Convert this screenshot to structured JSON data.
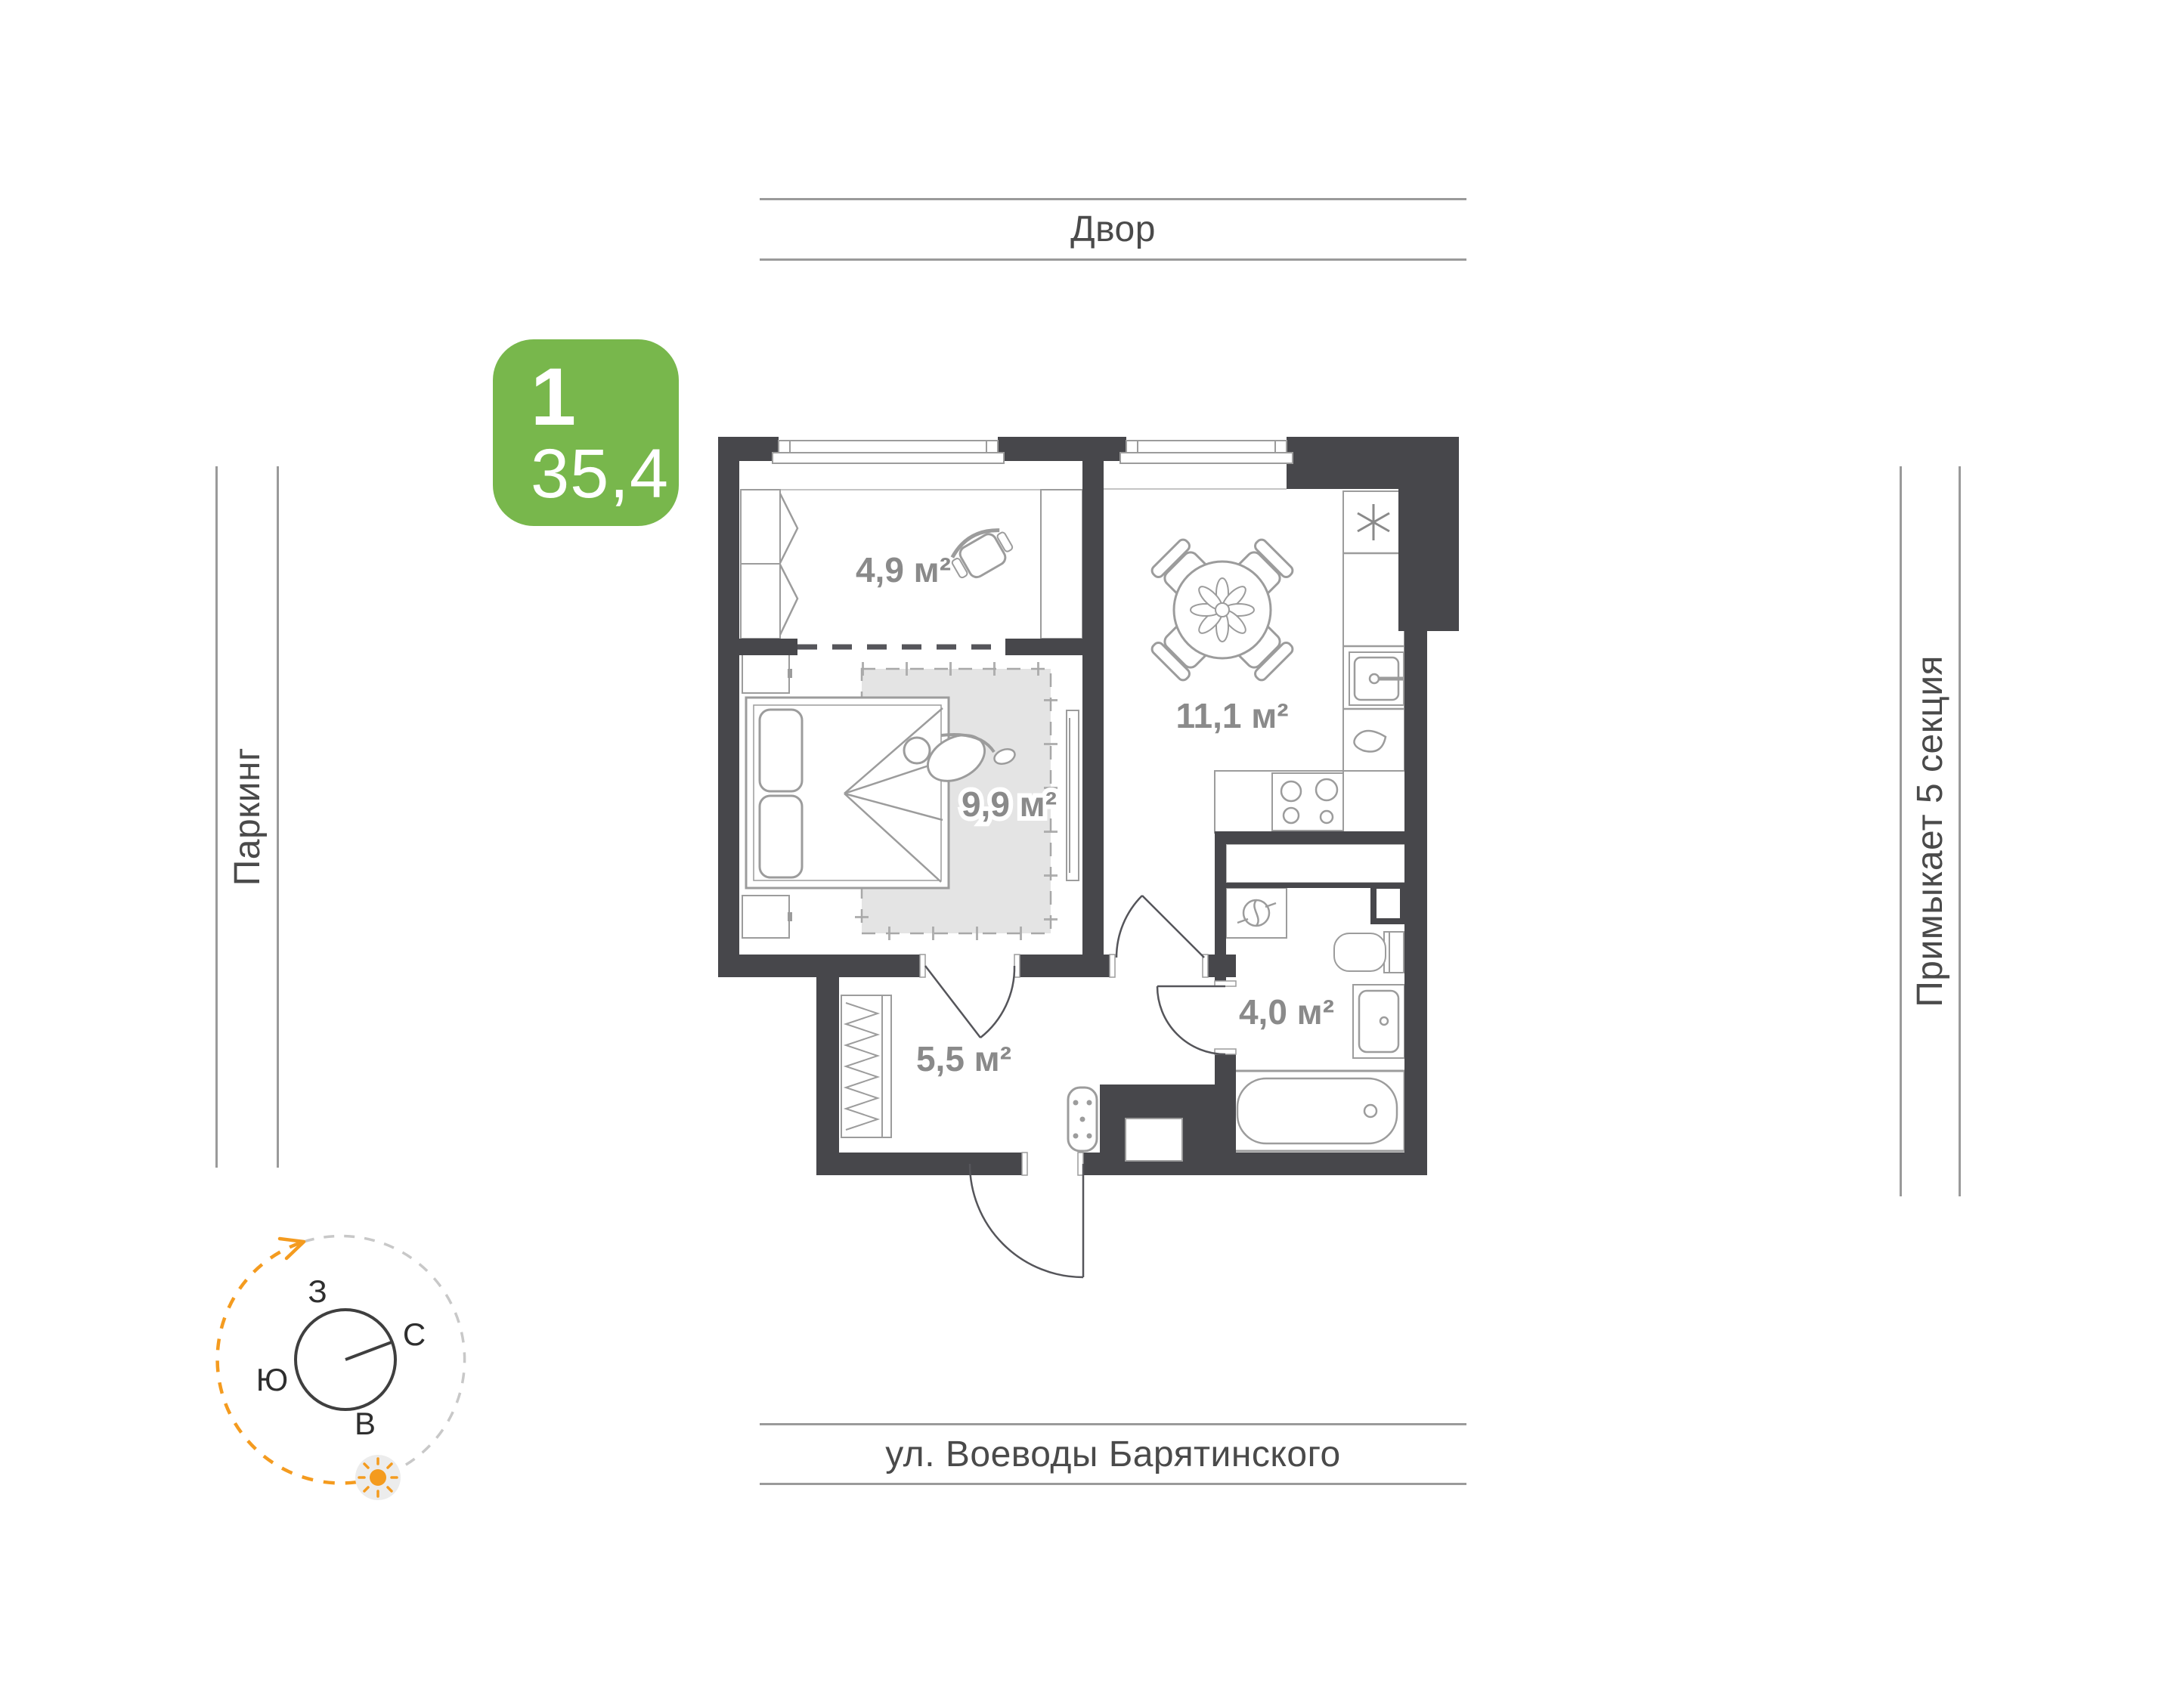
{
  "apartment_card": {
    "rooms_count": "1",
    "total_area": "35,4"
  },
  "context_labels": {
    "top": "Двор",
    "left": "Паркинг",
    "right": "Примыкает 5 секция",
    "bottom": "ул. Воеводы Барятинского"
  },
  "rooms": [
    {
      "id": "loggia",
      "area": "4,9 м²"
    },
    {
      "id": "bedroom",
      "area": "9,9 м²"
    },
    {
      "id": "kitchen-living",
      "area": "11,1 м²"
    },
    {
      "id": "hallway",
      "area": "5,5 м²"
    },
    {
      "id": "bathroom",
      "area": "4,0 м²"
    }
  ],
  "compass": {
    "west": "З",
    "north": "С",
    "south": "Ю",
    "east": "В"
  },
  "colors": {
    "badge_green": "#78B74C",
    "wall_dark": "#47474B",
    "furniture_line": "#9C9C9C",
    "area_label_gray": "#8A8A8A",
    "sun_orange": "#F49B1F"
  }
}
